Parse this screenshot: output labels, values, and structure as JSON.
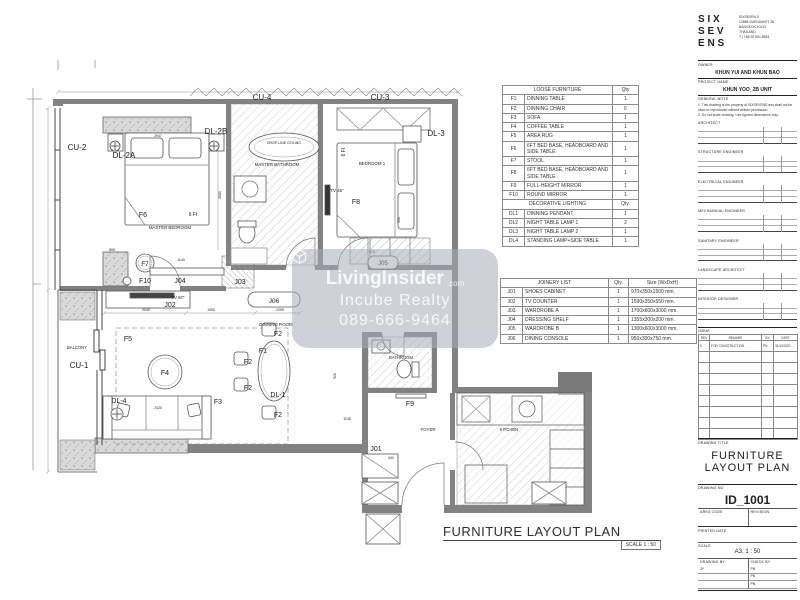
{
  "plan": {
    "title": "FURNITURE LAYOUT PLAN",
    "scale_note": "SCALE 1 : 50",
    "labels": [
      {
        "t": "CU-2",
        "x": 77,
        "y": 150,
        "s": 8
      },
      {
        "t": "DL-2A",
        "x": 124,
        "y": 158,
        "s": 8
      },
      {
        "t": "DL-2B",
        "x": 216,
        "y": 134,
        "s": 8
      },
      {
        "t": "DL-3",
        "x": 436,
        "y": 136,
        "s": 8
      },
      {
        "t": "CU-4",
        "x": 262,
        "y": 100,
        "s": 8
      },
      {
        "t": "CU-3",
        "x": 380,
        "y": 100,
        "s": 8
      },
      {
        "t": "F6",
        "x": 143,
        "y": 217,
        "s": 7
      },
      {
        "t": "6 Ft",
        "x": 193,
        "y": 216,
        "s": 5
      },
      {
        "t": "MASTER BEDROOM",
        "x": 170,
        "y": 229,
        "s": 4.4
      },
      {
        "t": "DROP-LINE CEILING",
        "x": 284,
        "y": 144,
        "s": 3.5
      },
      {
        "t": "MASTER BATHROOM",
        "x": 277,
        "y": 166,
        "s": 4.4
      },
      {
        "t": "BEDROOM 1",
        "x": 372,
        "y": 165,
        "s": 4.4
      },
      {
        "t": "6 Ft",
        "x": 345,
        "y": 152,
        "s": 5,
        "r": -90
      },
      {
        "t": "TV 46\"",
        "x": 337,
        "y": 192,
        "s": 4.4
      },
      {
        "t": "F8",
        "x": 356,
        "y": 204,
        "s": 7
      },
      {
        "t": "F7",
        "x": 145,
        "y": 266,
        "s": 6.5
      },
      {
        "t": "F10",
        "x": 145,
        "y": 283,
        "s": 7
      },
      {
        "t": "J04",
        "x": 180,
        "y": 283,
        "s": 7
      },
      {
        "t": "J03",
        "x": 240,
        "y": 284,
        "s": 7
      },
      {
        "t": "J05",
        "x": 383,
        "y": 265,
        "s": 6
      },
      {
        "t": "515",
        "x": 372,
        "y": 253,
        "s": 3.5
      },
      {
        "t": "TV 50\"",
        "x": 178,
        "y": 299,
        "s": 4.2
      },
      {
        "t": "J02",
        "x": 170,
        "y": 307,
        "s": 7
      },
      {
        "t": "J06",
        "x": 274,
        "y": 303,
        "s": 6.5
      },
      {
        "t": "DINNING ROOM",
        "x": 276,
        "y": 326,
        "s": 4.4
      },
      {
        "t": "F1",
        "x": 263,
        "y": 353,
        "s": 7
      },
      {
        "t": "F2",
        "x": 278,
        "y": 336,
        "s": 7
      },
      {
        "t": "F2",
        "x": 248,
        "y": 364,
        "s": 7
      },
      {
        "t": "F2",
        "x": 248,
        "y": 390,
        "s": 7
      },
      {
        "t": "F2",
        "x": 278,
        "y": 417,
        "s": 7
      },
      {
        "t": "DL-1",
        "x": 278,
        "y": 397,
        "s": 7
      },
      {
        "t": "F5",
        "x": 128,
        "y": 341,
        "s": 7
      },
      {
        "t": "F4",
        "x": 165,
        "y": 375,
        "s": 7
      },
      {
        "t": "F3",
        "x": 218,
        "y": 404,
        "s": 7
      },
      {
        "t": "DL-4",
        "x": 119,
        "y": 403,
        "s": 7
      },
      {
        "t": "BALCONY",
        "x": 77,
        "y": 349,
        "s": 4.2
      },
      {
        "t": "CU-1",
        "x": 79,
        "y": 368,
        "s": 8
      },
      {
        "t": "BATHROOM",
        "x": 401,
        "y": 359,
        "s": 4.2
      },
      {
        "t": "F9",
        "x": 410,
        "y": 406,
        "s": 7
      },
      {
        "t": "FOYER",
        "x": 428,
        "y": 431,
        "s": 4.4
      },
      {
        "t": "J01",
        "x": 376,
        "y": 451,
        "s": 7
      },
      {
        "t": "KITCHEN",
        "x": 509,
        "y": 431,
        "s": 4.2
      },
      {
        "t": "2947",
        "x": 158,
        "y": 137,
        "s": 3.5
      },
      {
        "t": "855",
        "x": 112,
        "y": 251,
        "s": 3.5
      },
      {
        "t": "1140",
        "x": 181,
        "y": 261,
        "s": 3.5
      },
      {
        "t": "2080",
        "x": 221,
        "y": 195,
        "s": 3.5,
        "r": -90
      },
      {
        "t": "900",
        "x": 400,
        "y": 220,
        "s": 3.5,
        "r": -90
      },
      {
        "t": "2040",
        "x": 146,
        "y": 311,
        "s": 3.5
      },
      {
        "t": "1953",
        "x": 211,
        "y": 311,
        "s": 3.5
      },
      {
        "t": "2295",
        "x": 280,
        "y": 311,
        "s": 3.5
      },
      {
        "t": "2420",
        "x": 158,
        "y": 409,
        "s": 3.5
      },
      {
        "t": "1138",
        "x": 347,
        "y": 420,
        "s": 3.5
      },
      {
        "t": "920",
        "x": 336,
        "y": 376,
        "s": 3.5,
        "r": -90
      },
      {
        "t": "540",
        "x": 391,
        "y": 459,
        "s": 3.5
      }
    ]
  },
  "watermark": {
    "brand": "LivingInsider",
    "brand_suffix": ".com",
    "line2": "Incube Realty",
    "phone": "089-666-9464",
    "bg": "rgba(168,172,184,0.55)",
    "text_color": "rgba(255,255,255,0.85)"
  },
  "loose_furniture": {
    "title": "LOOSE FURNITURE",
    "qty_header": "Qty",
    "rows": [
      [
        "F1",
        "DINNING TABLE",
        "1"
      ],
      [
        "F2",
        "DINNING CHAIR",
        "6"
      ],
      [
        "F3",
        "SOFA",
        "1"
      ],
      [
        "F4",
        "COFFEE TABLE",
        "1"
      ],
      [
        "F5",
        "AREA RUG",
        "1"
      ],
      [
        "F6",
        "6FT BED BASE, HEADBOARD AND SIDE TABLE",
        "1"
      ],
      [
        "F7",
        "STOOL",
        "1"
      ],
      [
        "F8",
        "6FT BED BASE, HEADBOARD AND SIDE TABLE",
        "1"
      ],
      [
        "F9",
        "FULL-HEIGHT MIRROR",
        "1"
      ],
      [
        "F10",
        "ROUND MIRROR",
        "1"
      ]
    ]
  },
  "decorative_lighting": {
    "title": "DECORATIVE LIGHTING",
    "qty_header": "Qty.",
    "rows": [
      [
        "DL1",
        "DINNING PENDANT",
        "1"
      ],
      [
        "DL2",
        "NIGHT TABLE LAMP 1",
        "2"
      ],
      [
        "DL3",
        "NIGHT TABLE LAMP 2",
        "1"
      ],
      [
        "DL4",
        "STANDING LAMP+SIDE TABLE",
        "1"
      ]
    ]
  },
  "joinery": {
    "title": "JOINERY LIST",
    "qty_header": "Qty.",
    "size_header": "Size (WxDxH)",
    "rows": [
      [
        "J01",
        "SHOES CABINET",
        "1",
        "970x350x1500 mm."
      ],
      [
        "J02",
        "TV COUNTER",
        "1",
        "1590x350x550 mm."
      ],
      [
        "J03",
        "WARDROBE A",
        "1",
        "1700x600x3000 mm."
      ],
      [
        "J04",
        "DRESSING SHELF",
        "1",
        "1355x300x200 mm."
      ],
      [
        "J05",
        "WARDROBE B",
        "1",
        "1300x600x3000 mm."
      ],
      [
        "J06",
        "DINING CONSOLE",
        "1",
        "950x300x750 mm."
      ]
    ]
  },
  "titleblock": {
    "logo_rows": [
      "S I X",
      "S E V",
      "E N S"
    ],
    "address": [
      "SIXSEVEN.S",
      "12888 SUKHUMVIT 38",
      "BANGKOK 10110",
      "THAILAND",
      "T | +66 92 891 8894"
    ],
    "owner_label": "OWNER",
    "owner": "KHUN YUI AND KHUN BAO",
    "project_label": "PROJECT NAME",
    "project": "KHUN YOO_2B UNIT",
    "note_label": "GENERAL NOTE",
    "notes": [
      "1.  This drawing is the property of SIXSEVENS and shall not be used or reproduced without written permission.",
      "2.  Do not scale drawing. Use figured dimensions only."
    ],
    "consultants": [
      "ARCHITECT",
      "STRUCTURE ENGINEER",
      "ELECTRICAL ENGINEER",
      "MECHANICAL ENGINEER",
      "SANITARY ENGINEER",
      "LANDSCAPE ARCHITECT",
      "INTERIOR DESIGNER"
    ],
    "issue_label": "ISSUE",
    "issue_headers": [
      "REV",
      "REMARK",
      "BY",
      "DATE"
    ],
    "issue_rows": [
      [
        "0",
        "FOR CONSTRUCTION",
        "PN",
        "31/10/2021"
      ]
    ],
    "drawing_title_label": "DRAWING TITLE",
    "drawing_title_line1": "FURNITURE",
    "drawing_title_line2": "LAYOUT PLAN",
    "drawing_no_label": "DRAWING NO",
    "drawing_no": "ID_1001",
    "area_code_label": "AREA CODE",
    "revision_label": "REVISION",
    "printed_label": "PRINTED DATE",
    "scale_label": "SCALE",
    "scale_value": "A3, 1 : 50",
    "drawn_label": "DRAWING BY",
    "drawn_value": "JY",
    "check_label": "CHECK BY",
    "check_values": [
      "PN",
      "PN",
      "PN"
    ]
  },
  "colors": {
    "wall": "#828282",
    "line": "#4a4a4a",
    "hatch": "#b2b2b2",
    "text": "#1d1d1d"
  }
}
